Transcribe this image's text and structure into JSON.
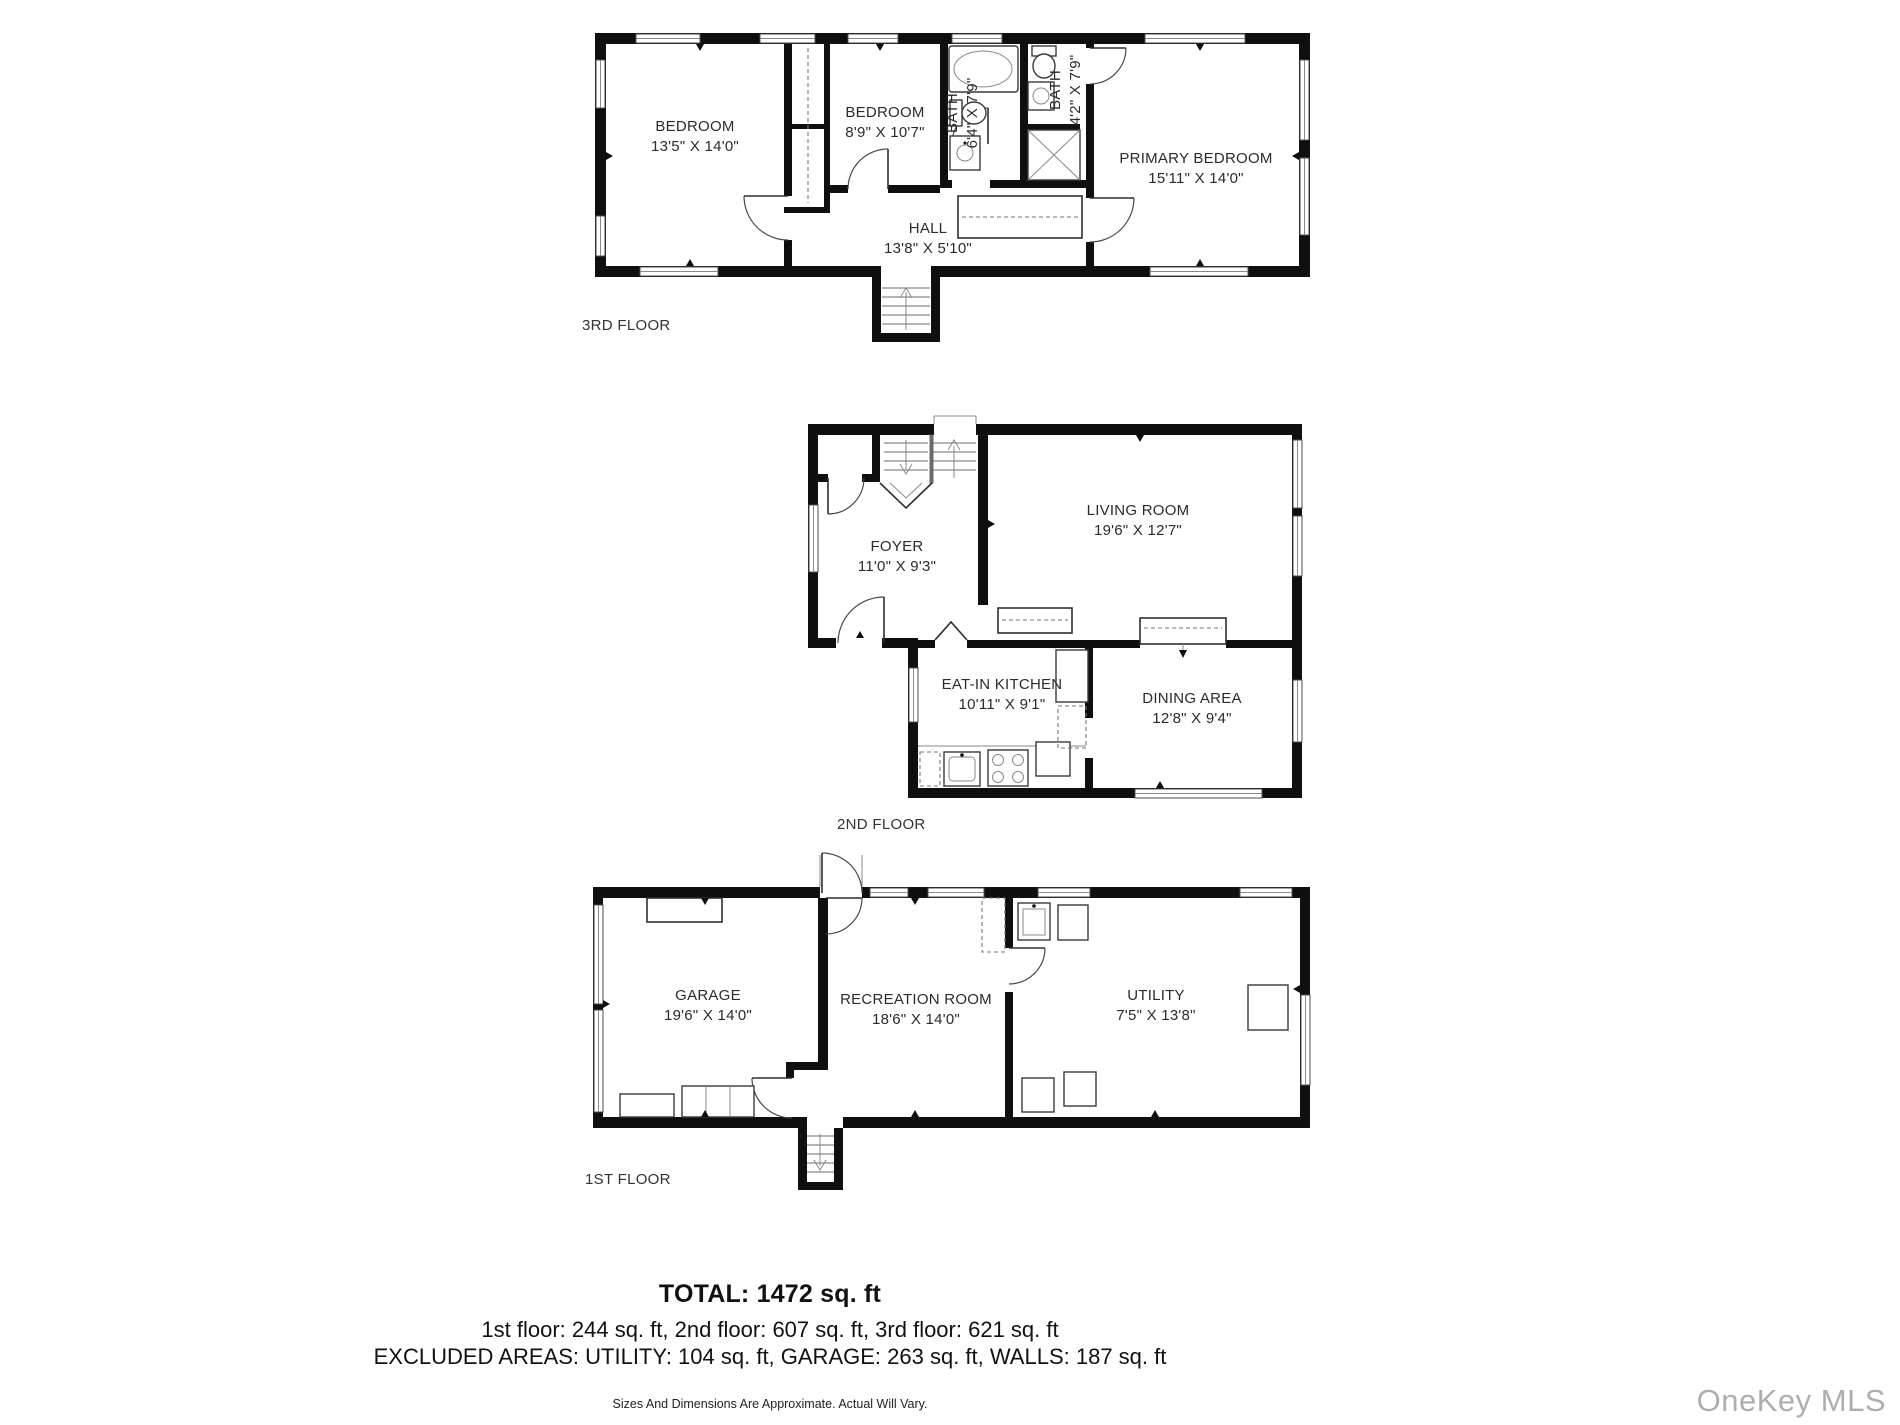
{
  "floors": [
    {
      "label": "3RD FLOOR",
      "rooms": [
        {
          "name": "BEDROOM",
          "dims": "13'5\" X 14'0\""
        },
        {
          "name": "BEDROOM",
          "dims": "8'9\" X 10'7\""
        },
        {
          "name": "BATH",
          "dims": "6'4\" X 7'9\""
        },
        {
          "name": "BATH",
          "dims": "4'2\" X 7'9\""
        },
        {
          "name": "PRIMARY BEDROOM",
          "dims": "15'11\" X 14'0\""
        },
        {
          "name": "HALL",
          "dims": "13'8\" X 5'10\""
        }
      ]
    },
    {
      "label": "2ND FLOOR",
      "rooms": [
        {
          "name": "FOYER",
          "dims": "11'0\" X 9'3\""
        },
        {
          "name": "LIVING ROOM",
          "dims": "19'6\" X 12'7\""
        },
        {
          "name": "EAT-IN KITCHEN",
          "dims": "10'11\" X 9'1\""
        },
        {
          "name": "DINING AREA",
          "dims": "12'8\" X 9'4\""
        }
      ]
    },
    {
      "label": "1ST FLOOR",
      "rooms": [
        {
          "name": "GARAGE",
          "dims": "19'6\" X 14'0\""
        },
        {
          "name": "RECREATION ROOM",
          "dims": "18'6\" X 14'0\""
        },
        {
          "name": "UTILITY",
          "dims": "7'5\" X 13'8\""
        }
      ]
    }
  ],
  "summary": {
    "total": "TOTAL: 1472 sq. ft",
    "floors_line": "1st floor: 244 sq. ft, 2nd floor: 607 sq. ft, 3rd floor: 621 sq. ft",
    "excluded_line": "EXCLUDED AREAS: UTILITY: 104 sq. ft, GARAGE: 263 sq. ft, WALLS: 187 sq. ft",
    "disclaimer": "Sizes And Dimensions Are Approximate. Actual Will Vary."
  },
  "watermark": "OneKey MLS",
  "colors": {
    "wall": "#0f0f0f",
    "text": "#2b2b2b",
    "watermark": "#aeaeae"
  }
}
